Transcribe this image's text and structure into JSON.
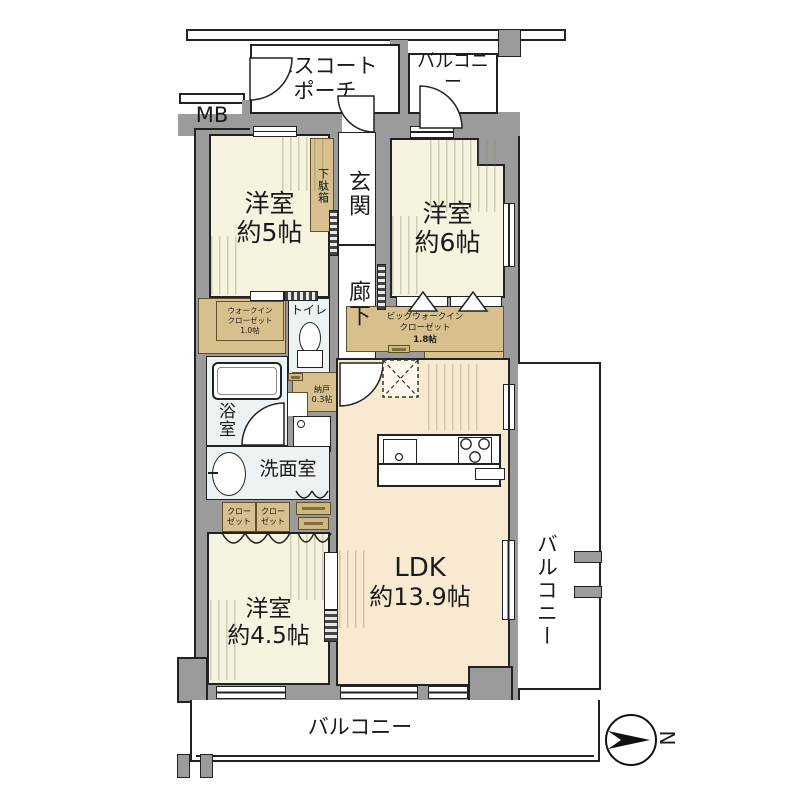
{
  "colors": {
    "wall": "#9b9b9b",
    "room_floor": "#f6f3e0",
    "ldk_floor": "#f8ead0",
    "closet_tan": "#d8c08e",
    "wet_room": "#edf2f4",
    "outline": "#222222"
  },
  "rooms": {
    "escort_porch": {
      "line1": "エスコート",
      "line2": "ポーチ"
    },
    "balcony_top": {
      "label": "バルコニー"
    },
    "mb": {
      "label": "MB"
    },
    "bedroom5": {
      "name": "洋室",
      "size": "約5帖"
    },
    "bedroom6": {
      "name": "洋室",
      "size": "約6帖"
    },
    "shoe_cabinet": {
      "label": "下駄箱"
    },
    "entrance": {
      "label": "玄関"
    },
    "corridor": {
      "label": "廊下"
    },
    "walk_in_closet": {
      "line1": "ウォークイン",
      "line2": "クローゼット",
      "line3": "1.0帖"
    },
    "toilet": {
      "label": "トイレ"
    },
    "big_walk_in_closet": {
      "line1": "ビッグウォークイン",
      "line2": "クローゼット",
      "line3": "1.8帖"
    },
    "bathroom": {
      "label": "浴室"
    },
    "storage": {
      "line1": "納戸",
      "line2": "0.3帖"
    },
    "washroom": {
      "label": "洗面室"
    },
    "closet_a": {
      "line1": "クロー",
      "line2": "ゼット"
    },
    "closet_b": {
      "line1": "クロー",
      "line2": "ゼット"
    },
    "bedroom45": {
      "name": "洋室",
      "size": "約4.5帖"
    },
    "ldk": {
      "name": "LDK",
      "size": "約13.9帖"
    },
    "balcony_right": {
      "label": "バルコニー"
    },
    "balcony_bottom": {
      "label": "バルコニー"
    }
  },
  "compass": {
    "north": "N"
  }
}
